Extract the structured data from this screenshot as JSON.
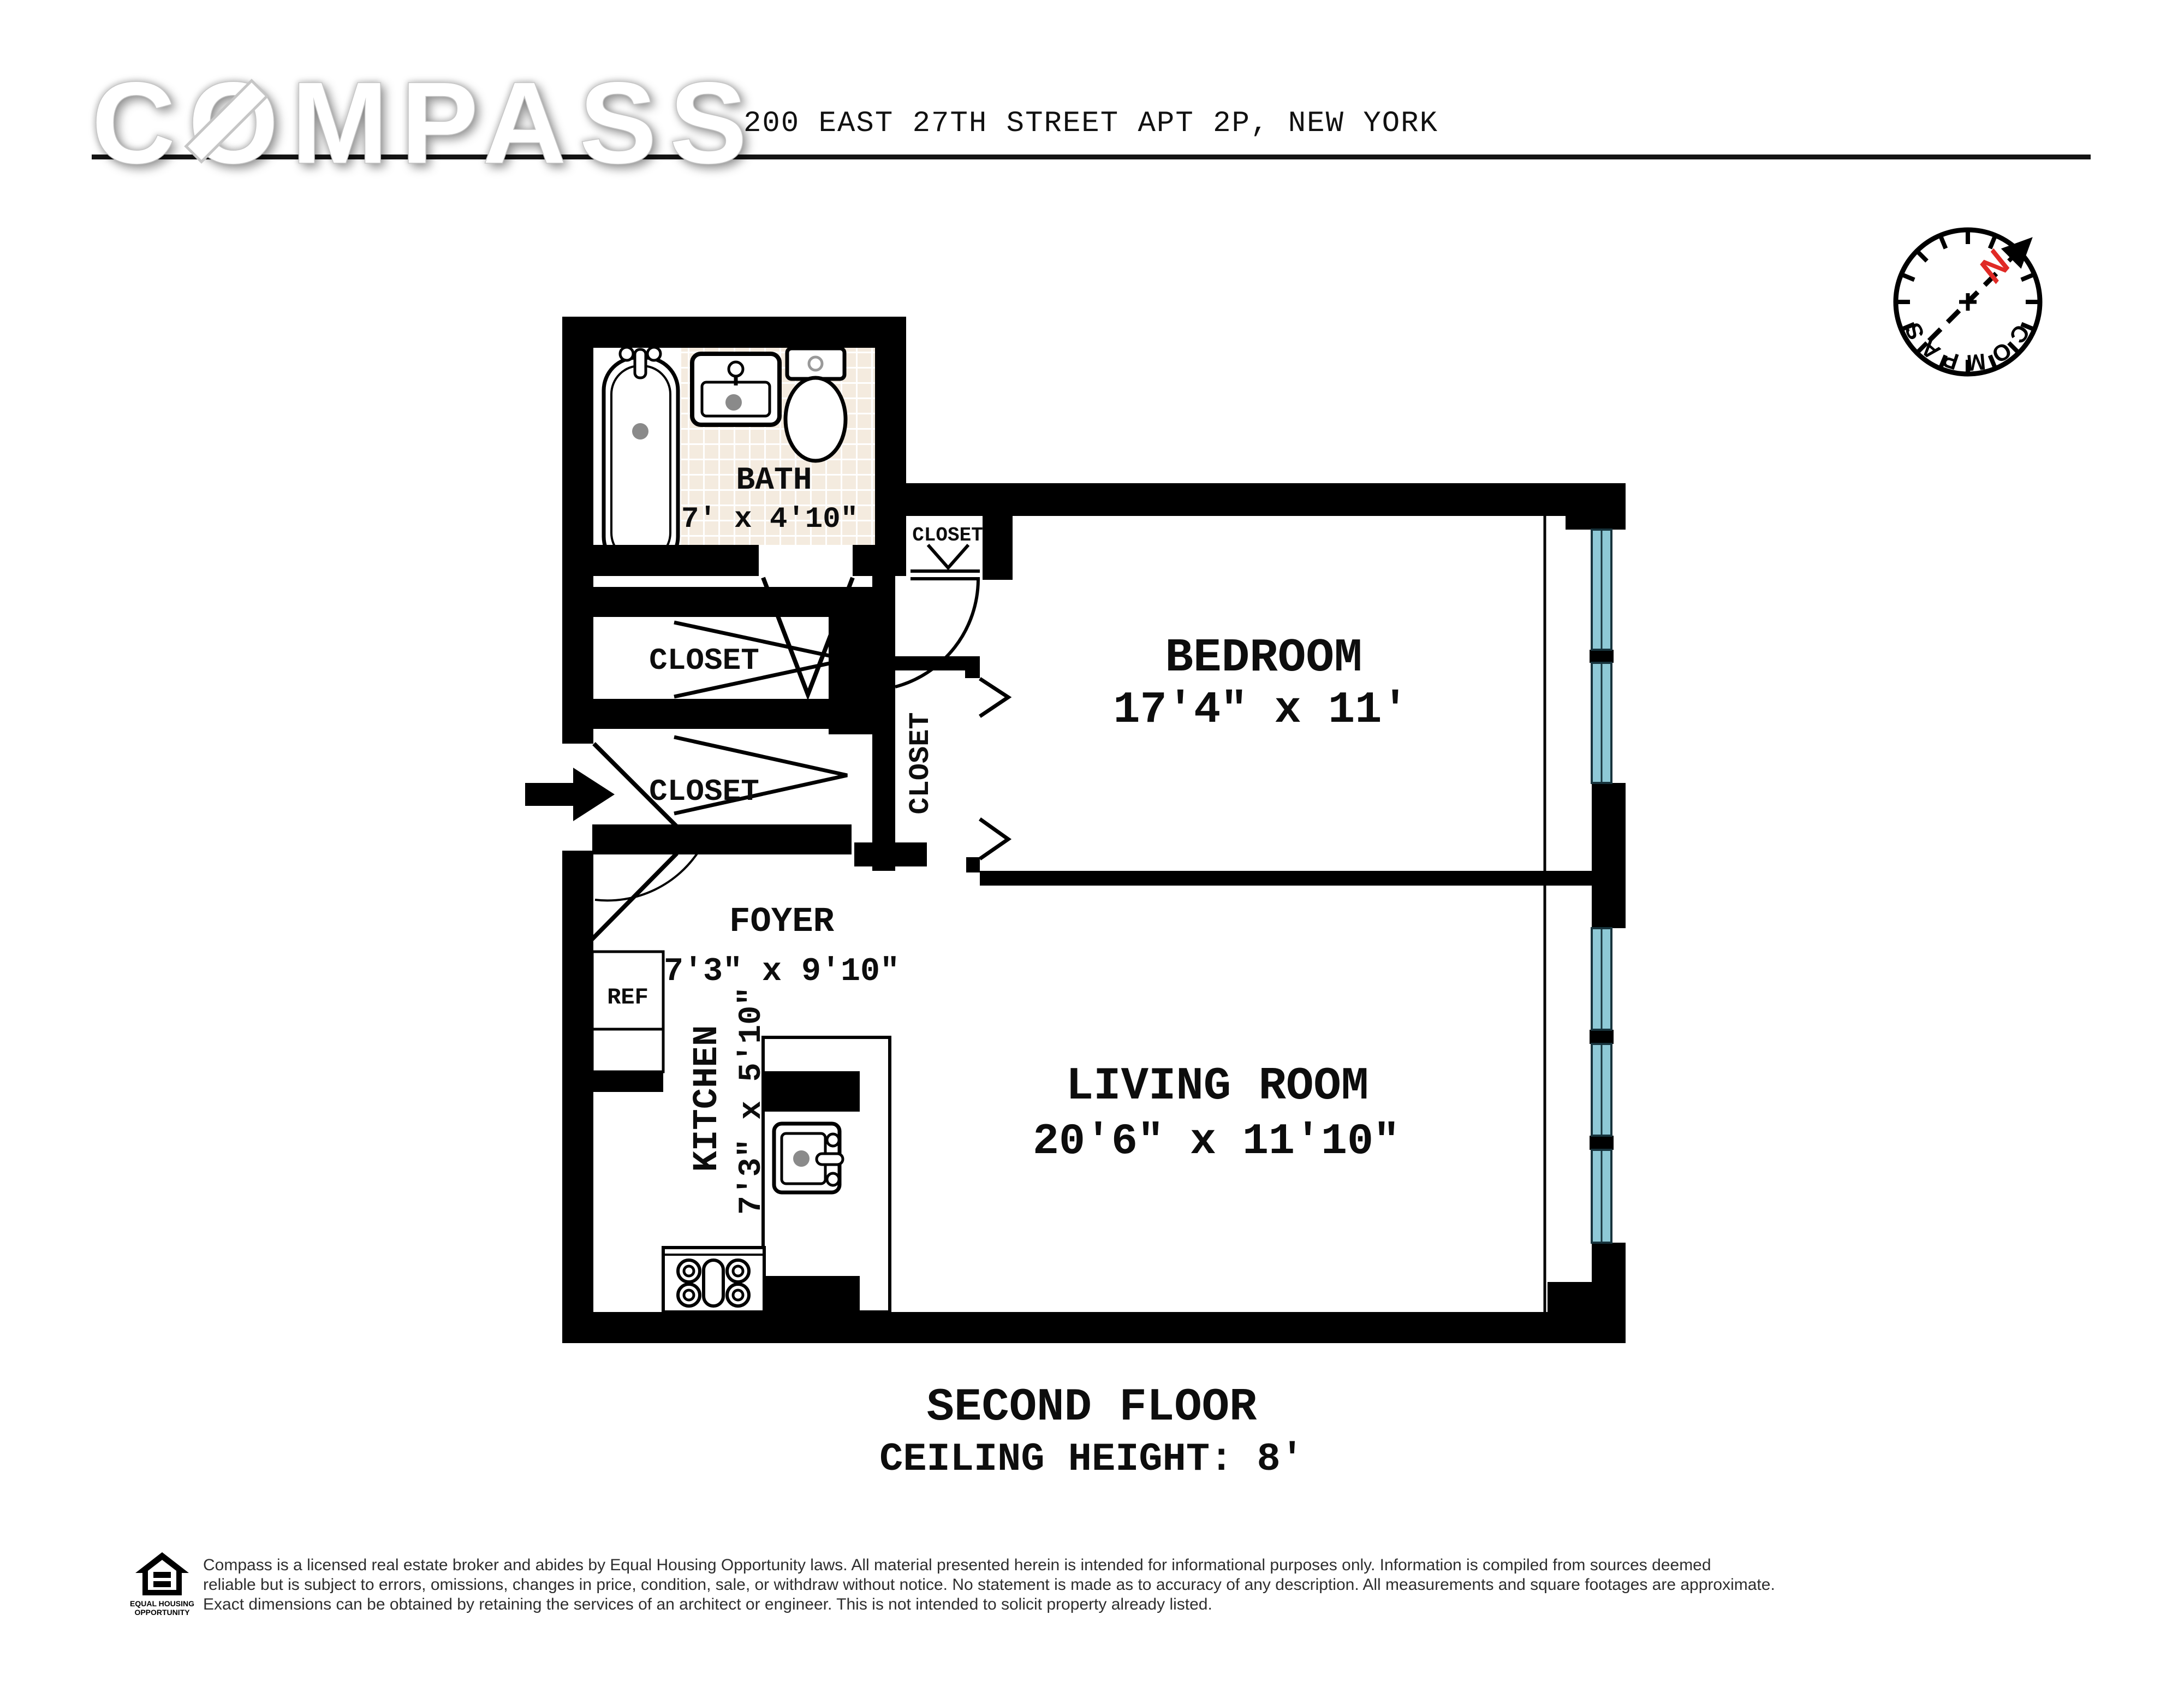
{
  "header": {
    "logo_text": "COMPASS",
    "address": "200 EAST 27TH STREET APT 2P, NEW YORK"
  },
  "compass_rose": {
    "north_label": "N",
    "ring_text": "COMPASS",
    "north_color": "#e02a26"
  },
  "floor_plan": {
    "rooms": [
      {
        "name": "BATH",
        "dims": "7' x 4'10\""
      },
      {
        "name": "BEDROOM",
        "dims": "17'4\" x 11'"
      },
      {
        "name": "FOYER",
        "dims": "7'3\" x 9'10\""
      },
      {
        "name": "KITCHEN",
        "dims": "7'3\" x 5'10\""
      },
      {
        "name": "LIVING ROOM",
        "dims": "20'6\" x 11'10\""
      }
    ],
    "closets": [
      "CLOSET",
      "CLOSET",
      "CLOSET",
      "CLOSET"
    ],
    "appliance_labels": {
      "refrigerator": "REF"
    },
    "colors": {
      "wall": "#000000",
      "window_glass": "#8ec9d6",
      "tile": "#f4ebdf",
      "grout": "#ffffff",
      "north_red": "#e02a26"
    }
  },
  "title": {
    "line1": "SECOND FLOOR",
    "line2": "CEILING HEIGHT: 8'"
  },
  "footer": {
    "eho_line1": "EQUAL HOUSING",
    "eho_line2": "OPPORTUNITY",
    "lines": [
      "Compass is a licensed real estate broker and abides by Equal Housing Opportunity laws. All material presented herein is intended for informational purposes only. Information is compiled from sources deemed",
      "reliable but is subject to errors, omissions, changes in price, condition, sale, or withdraw without notice. No statement is made as to accuracy of any description. All measurements and square footages are approximate.",
      "Exact dimensions can be obtained by retaining the services of an architect or engineer. This is not intended to solicit property already listed."
    ]
  }
}
